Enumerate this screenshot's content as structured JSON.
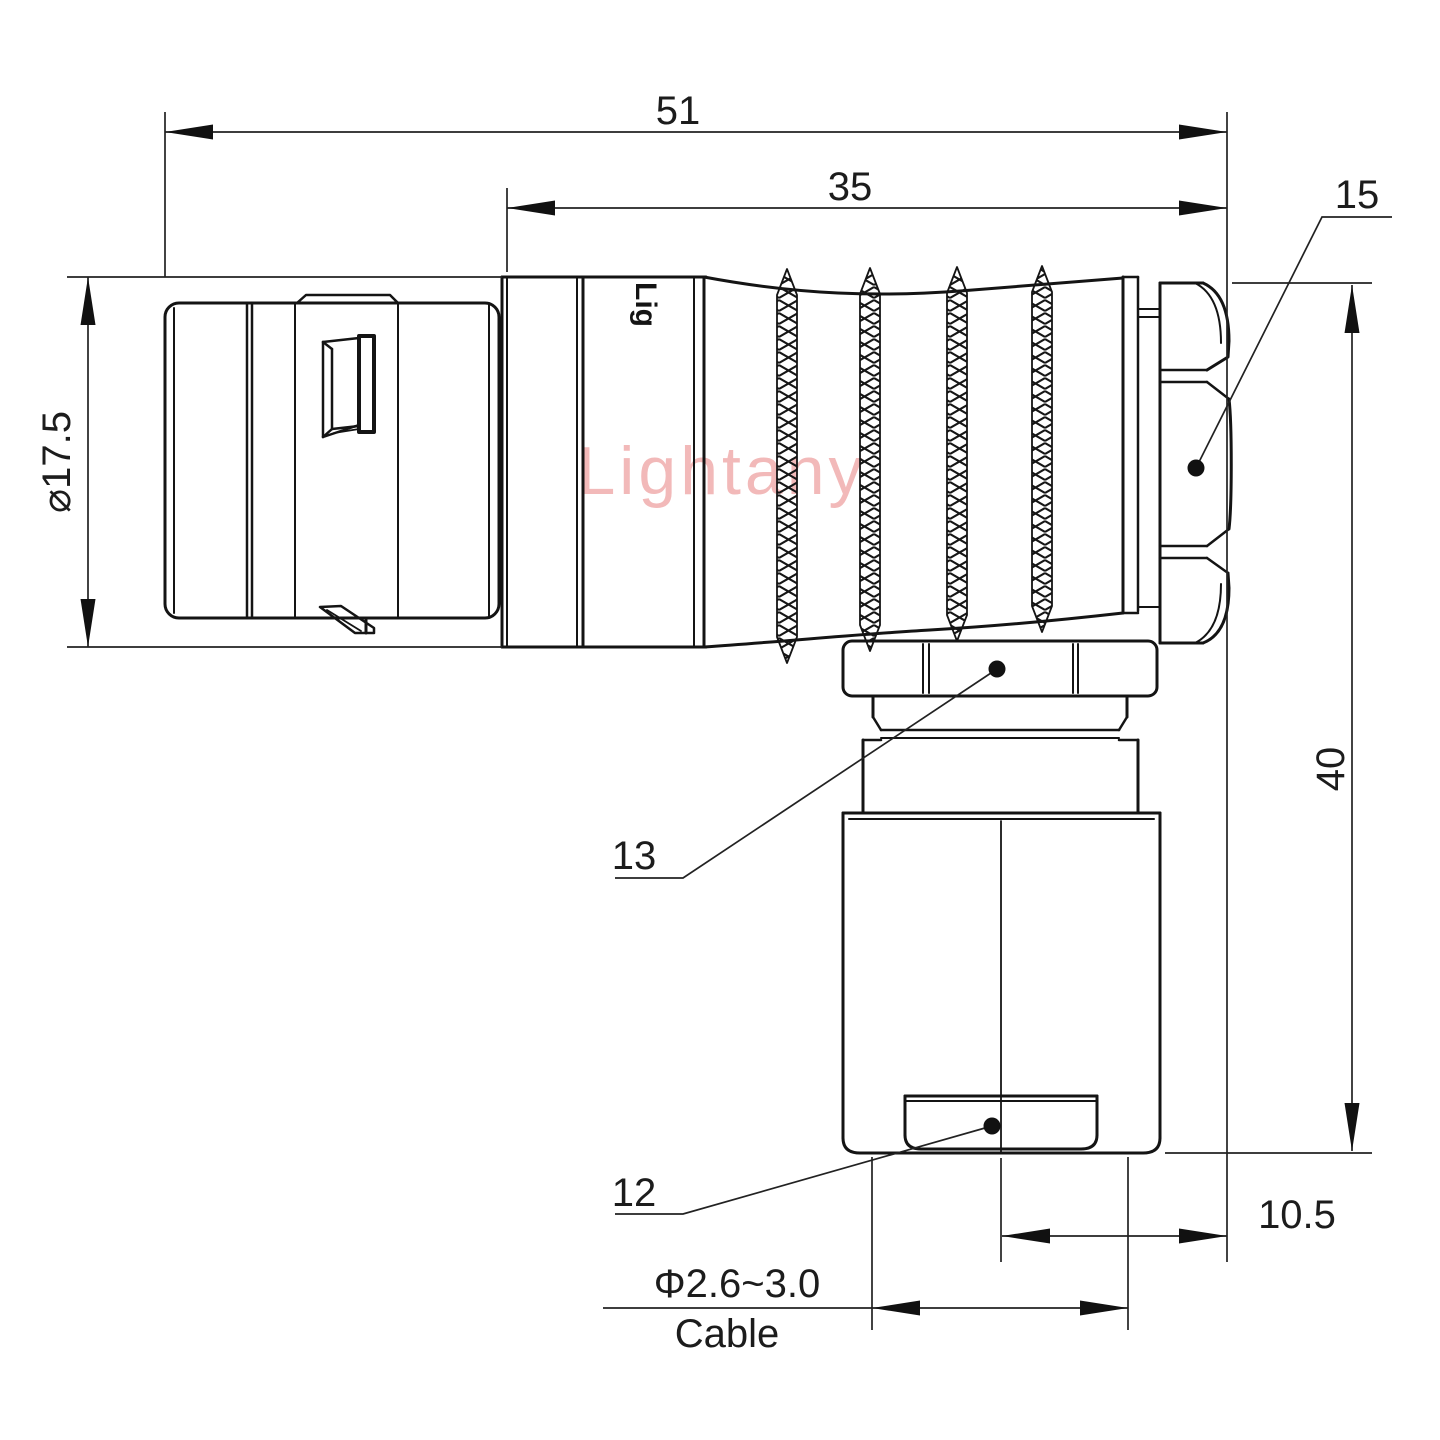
{
  "drawing": {
    "watermark": "Lightany",
    "body_marking": "Lig",
    "colors": {
      "line": "#141414",
      "dimension_line": "#222222",
      "watermark": "#f2b9b9",
      "background": "#ffffff"
    },
    "dimensions": {
      "overall_length": "51",
      "rear_section_length": "35",
      "rear_nut_callout": "15",
      "front_shell_diameter": "⌀17.5",
      "overall_height": "40",
      "coupling_nut_callout": "13",
      "cable_bushing_callout": "12",
      "cable_axis_offset": "10.5",
      "cable_diameter_range": "Φ2.6~3.0",
      "cable_label": "Cable"
    }
  }
}
